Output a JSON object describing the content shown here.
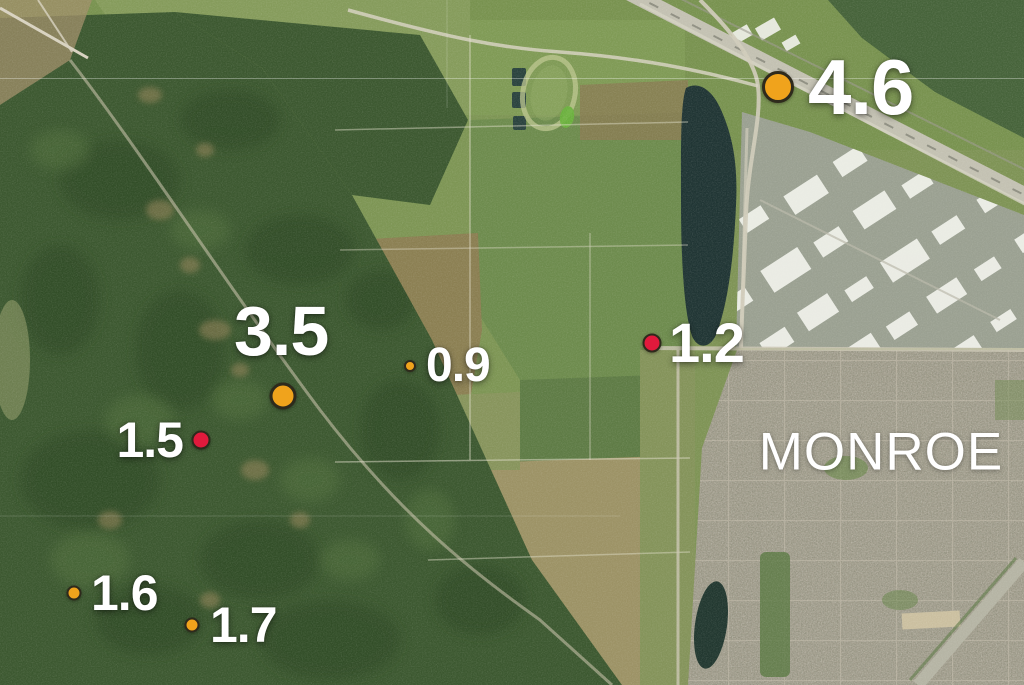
{
  "map": {
    "city_label": "MONROE",
    "marker_colors": {
      "orange": "#F0A31C",
      "red": "#E11A3C",
      "outline": "#2E2A1C",
      "label_text": "#FFFFFF"
    },
    "markers": [
      {
        "magnitude": "4.6",
        "color": "orange",
        "size": "xl",
        "x": 778,
        "y": 87
      },
      {
        "magnitude": "3.5",
        "color": "orange",
        "size": "lg",
        "x": 283,
        "y": 396
      },
      {
        "magnitude": "0.9",
        "color": "orange",
        "size": "xs",
        "x": 410,
        "y": 366
      },
      {
        "magnitude": "1.2",
        "color": "red",
        "size": "md",
        "x": 652,
        "y": 343
      },
      {
        "magnitude": "1.5",
        "color": "red",
        "size": "md",
        "x": 201,
        "y": 440
      },
      {
        "magnitude": "1.6",
        "color": "orange",
        "size": "sm",
        "x": 74,
        "y": 593
      },
      {
        "magnitude": "1.7",
        "color": "orange",
        "size": "sm",
        "x": 192,
        "y": 625
      }
    ]
  }
}
